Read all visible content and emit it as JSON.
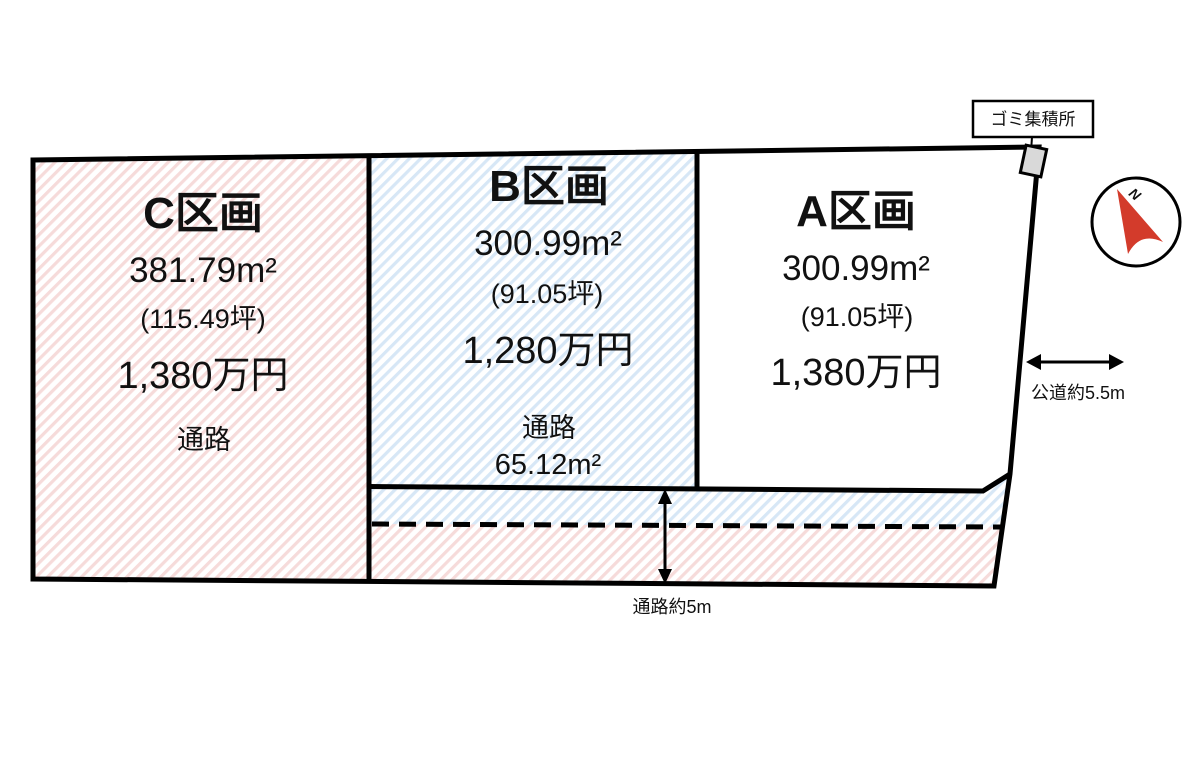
{
  "plots": [
    {
      "id": "A",
      "name": "A区画",
      "area": "300.99m²",
      "tsubo": "(91.05坪)",
      "price": "1,380万円"
    },
    {
      "id": "B",
      "name": "B区画",
      "area": "300.99m²",
      "tsubo": "(91.05坪)",
      "price": "1,280万円",
      "corridor_label": "通路",
      "corridor_area": "65.12m²"
    },
    {
      "id": "C",
      "name": "C区画",
      "area": "381.79m²",
      "tsubo": "(115.49坪)",
      "price": "1,380万円",
      "corridor_label": "通路"
    }
  ],
  "annotations": {
    "garbage_station": "ゴミ集積所",
    "public_road": "公道約5.5m",
    "corridor_width": "通路約5m",
    "compass_north": "N"
  },
  "colors": {
    "pink_hatch": "#f6dbda",
    "blue_hatch": "#d7e7f6",
    "outline": "#000000",
    "garbage_fill": "#d9d9d9",
    "compass_red": "#d33b2b"
  }
}
